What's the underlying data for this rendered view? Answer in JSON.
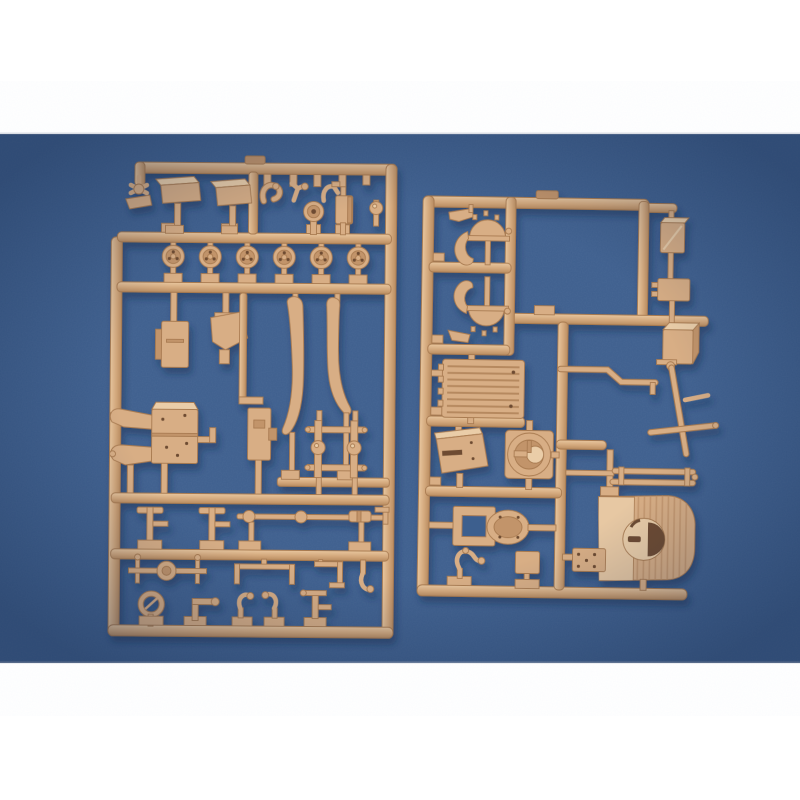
{
  "scene": {
    "description": "Product photograph of two tan injection-molded plastic model-kit sprues (part trees) lying on a blue textured backdrop, with plain white bands across the top and bottom of the frame",
    "colors": {
      "band": "#ffffff",
      "background": "#3e5f8e",
      "background_edge": "#24406c",
      "plastic": "#d8ae85",
      "plastic_light": "#eacda8",
      "plastic_dark": "#c2946a",
      "plastic_edge": "#a87a50",
      "hole": "#6e4c30",
      "shadow": "#16294d"
    },
    "sprues": [
      {
        "id": "left-sprue",
        "position": "left",
        "road_wheel_count": 6,
        "part_summary": [
          "two small rectangular box parts",
          "six spoked road wheels in a row",
          "disc and plate details",
          "two long curved fender stays",
          "gun-carriage bracket assembly",
          "ladder frame with ball joints",
          "tie-rod linkage",
          "axle with differential housing",
          "levers, hooks, ring pull and pipe fittings"
        ]
      },
      {
        "id": "right-sprue",
        "position": "right",
        "road_wheel_count": 0,
        "part_summary": [
          "two toothed crescent brackets",
          "slatted radiator / engine deck panel",
          "gun shield plate with slot",
          "turret ring on square plate",
          "oval hatch with rectangular frame",
          "curved superstructure front with round mount opening",
          "stacked box / tank parts on right runner",
          "rod assembly with crossbar and twin-rail part",
          "dogleg pipe"
        ]
      }
    ]
  }
}
